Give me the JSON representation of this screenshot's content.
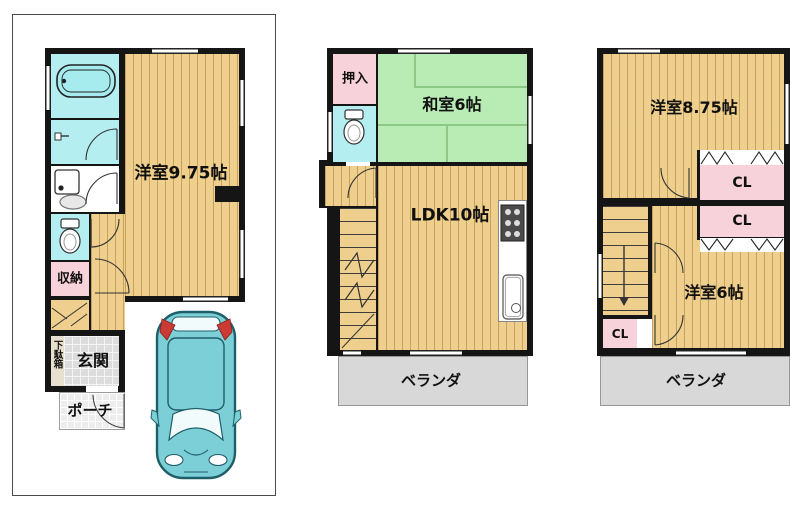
{
  "document": {
    "kind": "residential floor plan, 3 floors"
  },
  "colors": {
    "wall": "#151515",
    "wood_floor": "#eecf8d",
    "tatami_green": "#b9ecb4",
    "closet_pink": "#f8d2da",
    "wet_area_cyan": "#b4eef1",
    "veranda_gray": "#d8d8d8",
    "entrance_gray": "#dcdcdc",
    "car_teal": "#7ccfd6"
  },
  "floor1": {
    "room_main": "洋室9.75帖",
    "storage": "収納",
    "shoe_box": "下駄箱",
    "entrance": "玄関",
    "porch": "ポーチ"
  },
  "floor2": {
    "closet": "押入",
    "tatami_room": "和室6帖",
    "ldk": "LDK10帖",
    "veranda": "ベランダ"
  },
  "floor3": {
    "room_main": "洋室8.75帖",
    "closet1": "CL",
    "closet2": "CL",
    "room_small": "洋室6帖",
    "closet3": "CL",
    "veranda": "ベランダ"
  }
}
